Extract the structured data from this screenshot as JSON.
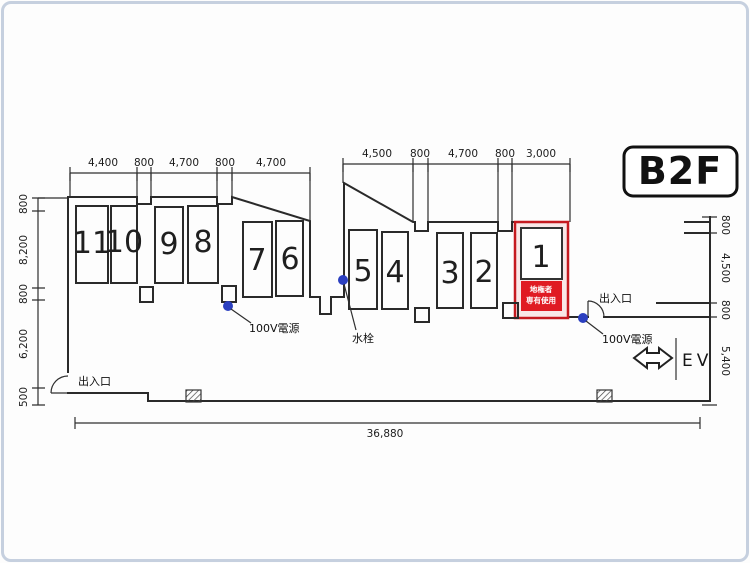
{
  "title_badge": "B2F",
  "colors": {
    "line": "#2a2a2a",
    "red_stroke": "#c5191f",
    "red_fill": "#e01b23",
    "red_band": "#f9e7e7",
    "blue_dot": "#2b3fc0",
    "frame": "#c6d0df"
  },
  "stalls": [
    {
      "label": "11"
    },
    {
      "label": "10"
    },
    {
      "label": "9"
    },
    {
      "label": "8"
    },
    {
      "label": "7"
    },
    {
      "label": "6"
    },
    {
      "label": "5"
    },
    {
      "label": "4"
    },
    {
      "label": "3"
    },
    {
      "label": "2"
    },
    {
      "label": "1"
    }
  ],
  "reserved_stall": {
    "number": "1",
    "line1": "地権者",
    "line2": "専有使用"
  },
  "dims": {
    "top_left": [
      "4,400",
      "800",
      "4,700",
      "800",
      "4,700"
    ],
    "top_mid": [
      "4,500",
      "800",
      "4,700",
      "800",
      "3,000"
    ],
    "left": [
      "800",
      "8,200",
      "800",
      "6,200",
      "500"
    ],
    "right": [
      "800",
      "4,500",
      "800",
      "5,400"
    ],
    "bottom": "36,880"
  },
  "labels": {
    "entrance_bottom_left": "出入口",
    "entrance_right": "出入口",
    "power_left": "100V電源",
    "power_right": "100V電源",
    "water_tap": "水栓",
    "elevator": "EV"
  }
}
